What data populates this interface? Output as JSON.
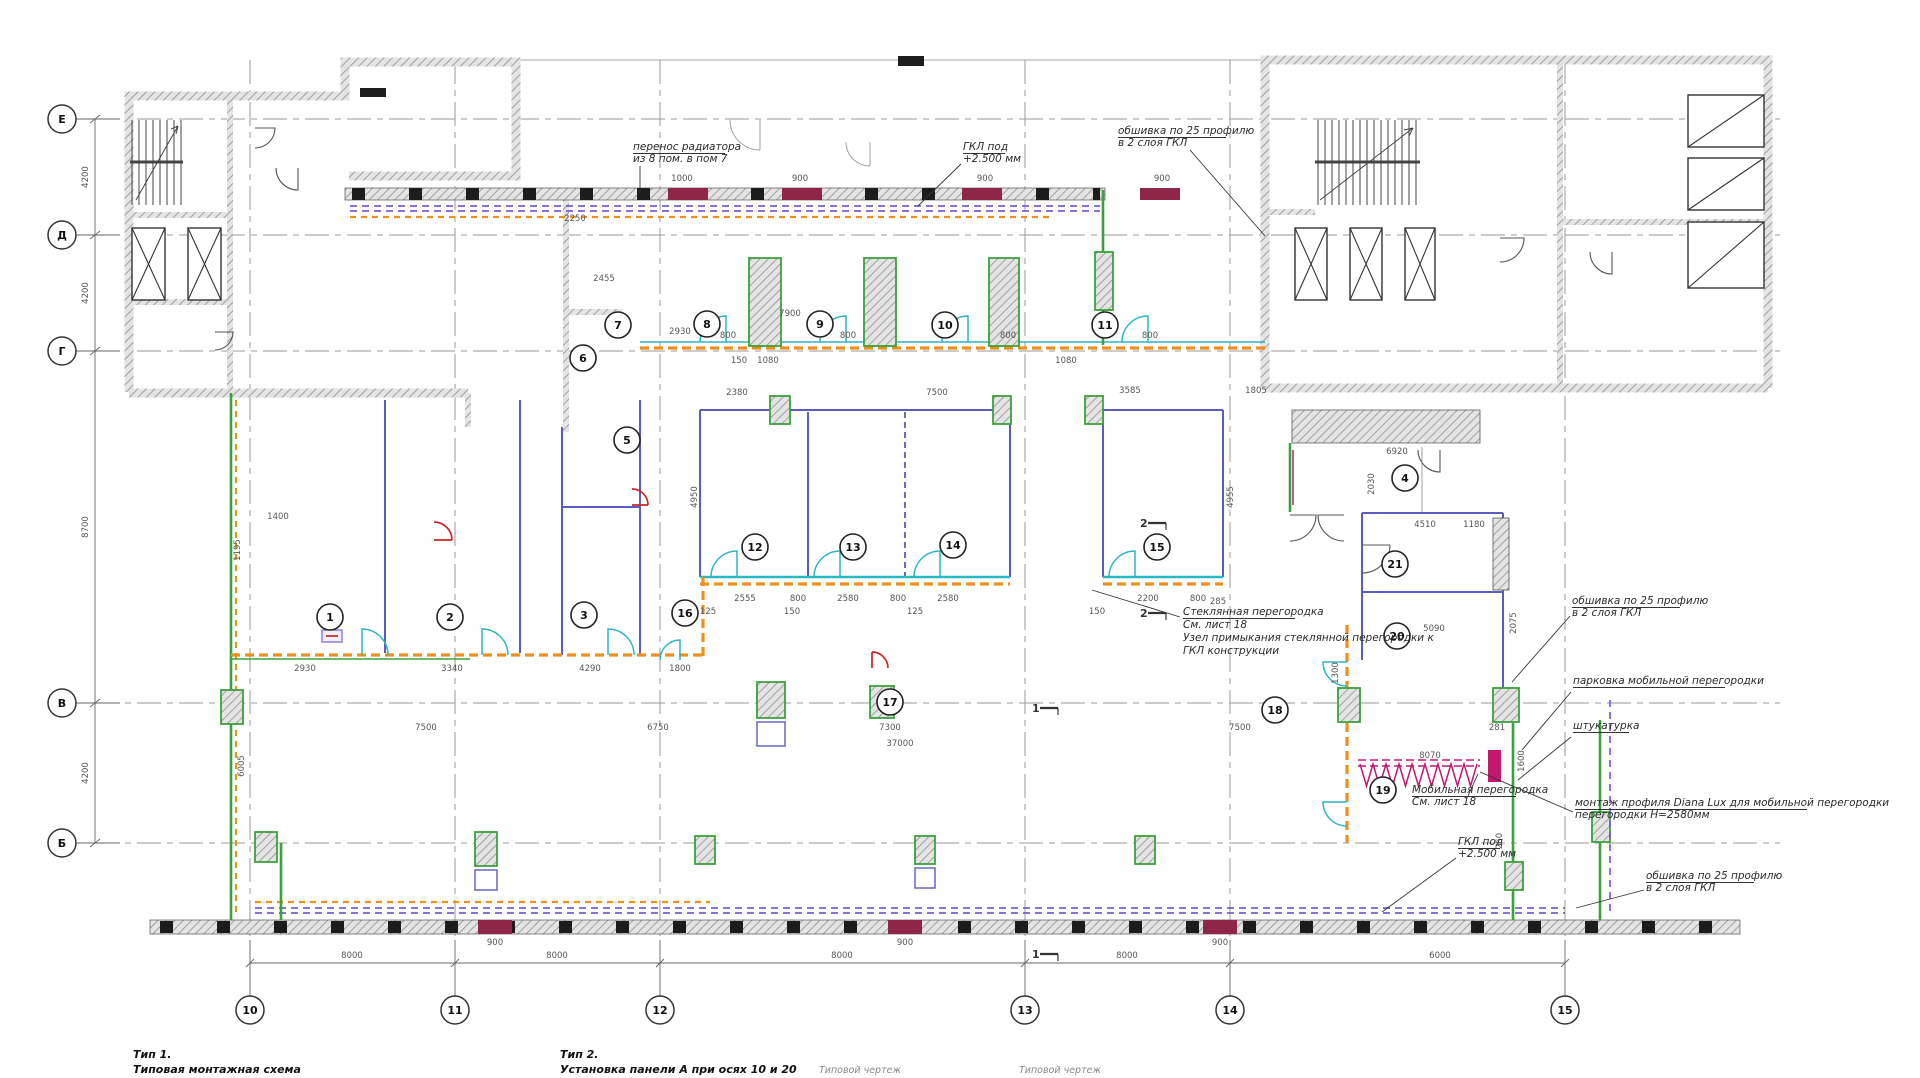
{
  "drawing": {
    "row_axes": [
      "Е",
      "Д",
      "Г",
      "В",
      "Б"
    ],
    "col_axes": [
      "10",
      "11",
      "12",
      "13",
      "14",
      "15"
    ],
    "row_dims": [
      "4200",
      "4200",
      "8700",
      "4200"
    ],
    "col_dims": [
      "8000",
      "8000",
      "8000",
      "8000",
      "6000"
    ],
    "rooms": [
      "1",
      "2",
      "3",
      "4",
      "5",
      "6",
      "7",
      "8",
      "9",
      "10",
      "11",
      "12",
      "13",
      "14",
      "15",
      "16",
      "17",
      "18",
      "19",
      "20",
      "21"
    ],
    "markers": [
      "2",
      "2",
      "1",
      "1"
    ],
    "dims": [
      "1000",
      "900",
      "900",
      "900",
      "2250",
      "2455",
      "7900",
      "2930",
      "800",
      "800",
      "800",
      "800",
      "150",
      "1080",
      "1080",
      "2380",
      "7500",
      "3585",
      "1805",
      "6920",
      "4950",
      "4955",
      "2030",
      "4510",
      "1180",
      "1400",
      "1195",
      "2555",
      "800",
      "2580",
      "800",
      "2580",
      "2200",
      "800",
      "125",
      "150",
      "125",
      "150",
      "285",
      "5090",
      "2075",
      "1300",
      "2930",
      "3340",
      "4290",
      "1800",
      "7500",
      "6750",
      "7300",
      "7500",
      "37000",
      "8070",
      "1600",
      "281",
      "260",
      "900",
      "900",
      "900",
      "6005"
    ],
    "annotations": {
      "radiator": [
        "перенос радиатора",
        "из 8 пом. в пом 7"
      ],
      "gkl_top": [
        "ГКЛ под",
        "+2.500 мм"
      ],
      "cladding_top": [
        "обшивка по 25 профилю",
        "в 2 слоя ГКЛ"
      ],
      "glass": [
        "Стеклянная перегородка",
        "См. лист 18",
        "Узел примыкания стеклянной перегородки к",
        "ГКЛ конструкции"
      ],
      "mobile": [
        "Мобильная перегородка",
        "См. лист 18"
      ],
      "gkl_bottom": [
        "ГКЛ под",
        "+2.500 мм"
      ],
      "cladding_r1": [
        "обшивка по 25 профилю",
        "в 2 слоя ГКЛ"
      ],
      "parking": [
        "парковка мобильной перегородки"
      ],
      "plaster": [
        "штукатурка"
      ],
      "diana": [
        "монтаж профиля Diana Lux для мобильной перегородки",
        "перегородки Н=2580мм"
      ],
      "cladding_r2": [
        "обшивка по 25 профилю",
        "в 2 слоя ГКЛ"
      ]
    },
    "footer": {
      "type1_title": "Тип 1.",
      "type1_text": "Типовая монтажная схема",
      "type2_title": "Тип 2.",
      "type2_text": "Установка панели А при осях 10 и 20",
      "caption1": "Типовой чертеж",
      "caption2": "Типовой чертеж"
    }
  }
}
